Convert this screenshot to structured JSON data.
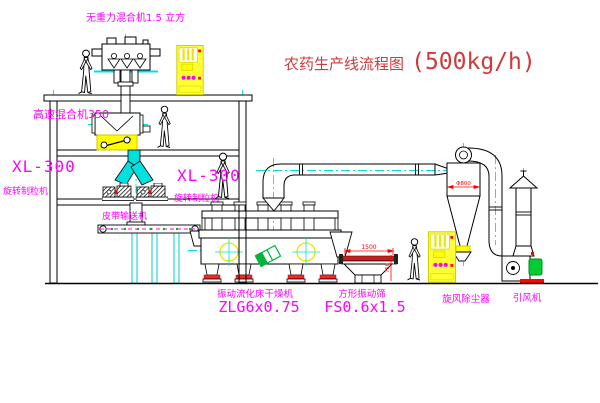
{
  "title": {
    "name": "农药生产线流程图",
    "capacity": "(500kg/h)"
  },
  "equipment": {
    "gravity_mixer": {
      "label": "无重力混合机1.5 立方"
    },
    "high_speed_mixer": {
      "label": "高速混合机350"
    },
    "granulator_left": {
      "model": "XL-300",
      "name": "旋转制粒机"
    },
    "granulator_right": {
      "model": "XL-300",
      "name": "旋转制粒机"
    },
    "belt_conveyor": {
      "label": "皮带输送机"
    },
    "fluid_bed_dryer": {
      "name": "振动流化床干燥机",
      "model": "ZLG6x0.75"
    },
    "vibrating_screen": {
      "name": "方形振动筛",
      "model": "FS0.6x1.5"
    },
    "cyclone_collector": {
      "name": "旋风除尘器"
    },
    "induced_draft_fan": {
      "name": "引风机"
    }
  },
  "dimensions": {
    "screen_length": "1500",
    "screen_height": "750",
    "cyclone_diameter": "Φ800"
  },
  "colors": {
    "line_black": "#000000",
    "centerline_cyan": "#00e0e0",
    "label_magenta": "#ff00ff",
    "title_red": "#cf3a3a",
    "dimension_red": "#ff0000",
    "cabinet_yellow": "#ffff00",
    "machine_green": "#00b43c",
    "screen_red": "#c41f1f"
  }
}
